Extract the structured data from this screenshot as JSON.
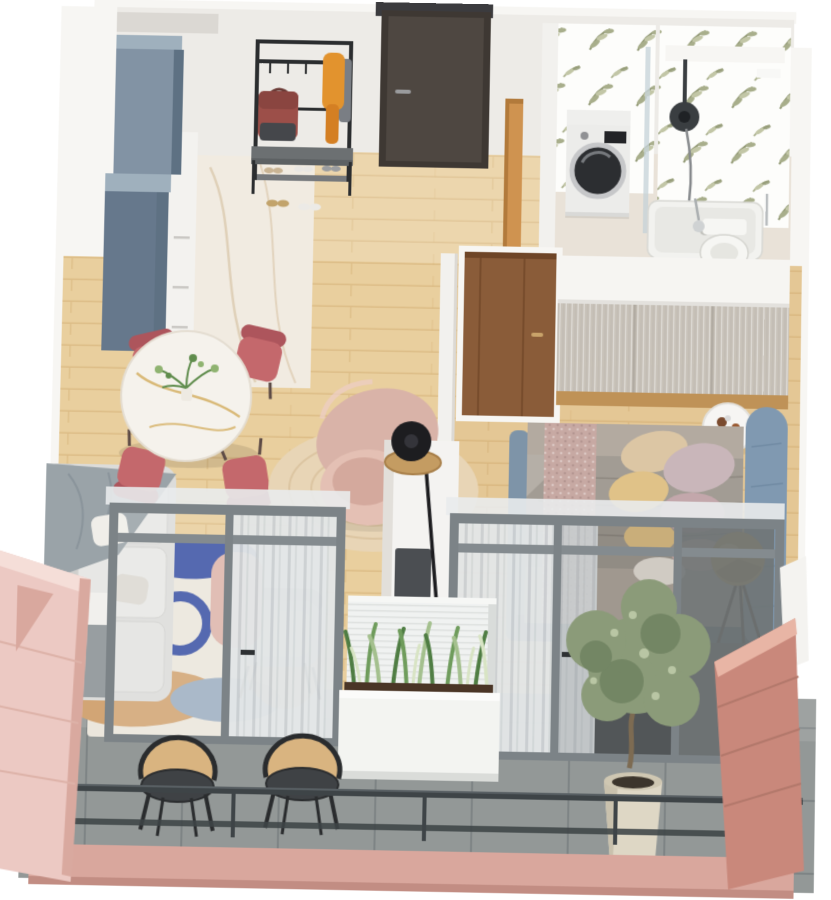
{
  "scene": {
    "type": "3d-floorplan-render",
    "style": "isometric top-down cutaway of a one-bedroom apartment with balcony",
    "background": "#ffffff"
  },
  "palette": {
    "wall_face": "#edebe7",
    "wall_white": "#f7f6f3",
    "wall_shade": "#dcd9d4",
    "niche": "#dbd8d3",
    "wood_floor": "#e9cf9e",
    "wood_line": "#d8b87f",
    "bedroom_tint": "#c9965a",
    "marble_floor": "#f1ebe1",
    "marble_vein": "#dbc9ae",
    "bath_floor": "#e9e2d8",
    "balcony_tile": "#939897",
    "tile_line": "#7e8485",
    "cabinet_blue": "#8293a4",
    "cabinet_blue_top": "#9fb0bd",
    "cabinet_blue_side": "#5e7183",
    "cabinet_blue_front": "#66788c",
    "cabinet_white": "#f3f2ef",
    "front_door": "#4e4741",
    "door_frame": "#3e3833",
    "door_header": "#3b3b3e",
    "rack_black": "#2b2d2f",
    "scarf_orange": "#e2932e",
    "scarf_tail": "#d47f23",
    "garment_gray": "#7a7e84",
    "bag_red": "#9c4f49",
    "bag_dark": "#45474b",
    "bench_top": "#6c7072",
    "bench_shelf": "#76797c",
    "wallpaper_white": "#fdfdfb",
    "leaf_dark": "#8f9671",
    "leaf_mid": "#a8ae8b",
    "leaf_light": "#c2c6a6",
    "washer_white": "#ececea",
    "drum_dark": "#2c2e31",
    "drum_ring": "#c6c7c9",
    "shower_glass": "#c4d2d8",
    "shower_head": "#3a3e41",
    "tray_white": "#f2f2ef",
    "toilet_white": "#f6f6f3",
    "bath_door_wood": "#cf9350",
    "mid_wall": "#f2f1ee",
    "walnut": "#8a5c39",
    "walnut_dark": "#6e4527",
    "wardrobe_top": "#f6f5f2",
    "wardrobe_front": "#c9c3ba",
    "wardrobe_seam": "#b1aba2",
    "wardrobe_wood": "#bf9257",
    "side_table": "#f6f5f3",
    "bed_frame": "#5d6e7d",
    "bed_side": "#7e94a8",
    "headboard": "#8099b1",
    "bedding": "#b3aaa0",
    "duvet": "#a29c94",
    "duvet_line": "#8e8880",
    "knit_throw": "#c7a9a3",
    "pillow_beige": "#dcc6a4",
    "pillow_yellow": "#e0c288",
    "pillow_lilac": "#c9b6ba",
    "pillow_mauve": "#c3a7ab",
    "pillow_white": "#e8e2da",
    "pillow_blush": "#d4b3ae",
    "brass": "#c79f52",
    "brass_dark": "#a67c3a",
    "brass_light": "#e8c87e",
    "lamp_leg": "#453b30",
    "table_top": "#f5f2ec",
    "table_vein": "#d4af63",
    "table_base": "#3a3734",
    "chair_rose": "#c4686c",
    "chair_rose_dark": "#ad555c",
    "chair_leg": "#5c4a45",
    "plant_green": "#5f8c4c",
    "plant_light": "#8fb370",
    "jute": "#e8d5b6",
    "jute_ring": "#d8c09c",
    "armchair_blush": "#d9b3a8",
    "armchair_light": "#e4c0b4",
    "armchair_seat": "#d4a99d",
    "lamp_black": "#1d1d20",
    "rattan": "#c49c62",
    "rattan_edge": "#a87f49",
    "partition": "#f4f3f1",
    "partition_shade": "#e2dfda",
    "tv_dark": "#4b4e52",
    "rug_base": "#ebe6dc",
    "rug_blue": "#3e55a5",
    "rug_tan": "#d2a575",
    "rug_tan2": "#d9b48c",
    "rug_slate": "#9fb0c2",
    "sofa_base": "#dcdcda",
    "sofa_back": "#cfcfcd",
    "sofa_cushion": "#e7e7e5",
    "throw_gray": "#9aa3a8",
    "accent_seat": "#cbcecd",
    "accent_back": "#bcbfbe",
    "accent_cushion": "#d8dad9",
    "metal_leg": "#3f4244",
    "pouf_blush": "#ddb6ab",
    "frame_gray": "#7c8387",
    "frame_gray2": "#848b8f",
    "curtain_light": "#e3e6e7",
    "curtain_mid": "#c8cdd0",
    "dark_recess": "#5c6062",
    "backdrop_gray": "#6f7475",
    "parapet": "#f0f2f1",
    "ridge_line": "#dde0de",
    "planter_white": "#f3f4f1",
    "sans_dark": "#4f7d43",
    "sans_mid": "#6f9c5c",
    "sans_light": "#a4c08e",
    "sans_pale": "#d8e4c4",
    "olive_leaf": "#8b9b79",
    "olive_dark": "#6e8160",
    "olive_light": "#b9c6a4",
    "trunk": "#7d6b52",
    "pot_cream": "#ded7c5",
    "pot_rim": "#cfc7b2",
    "soil": "#3c352c",
    "cane": "#d9b480",
    "chair_seat": "#3f4245",
    "chair_frame": "#2a2c2e",
    "railing": "#3e4447",
    "fascia": "#d9a79d",
    "fascia_edge": "#c28d83",
    "pink_wall": "#ecc9c3",
    "pink_edge": "#d9a99f",
    "pink_notch": "#d9a89e",
    "pink_seam": "#ddb2a8",
    "terracotta": "#c9887b",
    "terracotta_light": "#e8b5a5",
    "terracotta_seam": "#b2786b",
    "stub_gray": "#989ea1",
    "stub_white": "#f1f0ed",
    "white_sliver": "#f4f3f0"
  },
  "rooms": [
    {
      "id": "kitchen",
      "label": "Kitchen",
      "items": [
        "tall blue-gray cabinet",
        "blue-gray base cabinets",
        "white counter",
        "marble floor"
      ]
    },
    {
      "id": "entry",
      "label": "Entry Hall",
      "items": [
        "dark front door",
        "black coat rack",
        "orange scarf",
        "red bag",
        "shoe bench",
        "shoes"
      ]
    },
    {
      "id": "bathroom",
      "label": "Bathroom",
      "items": [
        "leaf-pattern wallpaper",
        "washing machine",
        "walk-in shower",
        "shower tray",
        "toilet",
        "toilet brush",
        "open wood door"
      ]
    },
    {
      "id": "living",
      "label": "Living / Dining Room",
      "items": [
        "round marble dining table",
        "four rose dining chairs",
        "plant centerpiece",
        "blush curved armchair",
        "round jute rug",
        "black floor lamp",
        "rattan tray table",
        "abstract area rug",
        "light gray sofa",
        "gray throw blanket",
        "gray accent chair",
        "blush pouf",
        "white TV partition",
        "wall TV"
      ]
    },
    {
      "id": "bedroom",
      "label": "Bedroom",
      "items": [
        "double bed",
        "blue upholstered headboard",
        "knitted throw",
        "pillows",
        "sliding-door wardrobe",
        "round side table",
        "brass tripod floor lamp",
        "walnut door"
      ]
    },
    {
      "id": "balcony",
      "label": "Balcony",
      "items": [
        "sliding glass doors",
        "sheer curtains",
        "two cane armchairs",
        "white planter with sansevieria",
        "olive tree in pot",
        "divider wall",
        "metal railing",
        "pink exterior walls"
      ]
    }
  ]
}
